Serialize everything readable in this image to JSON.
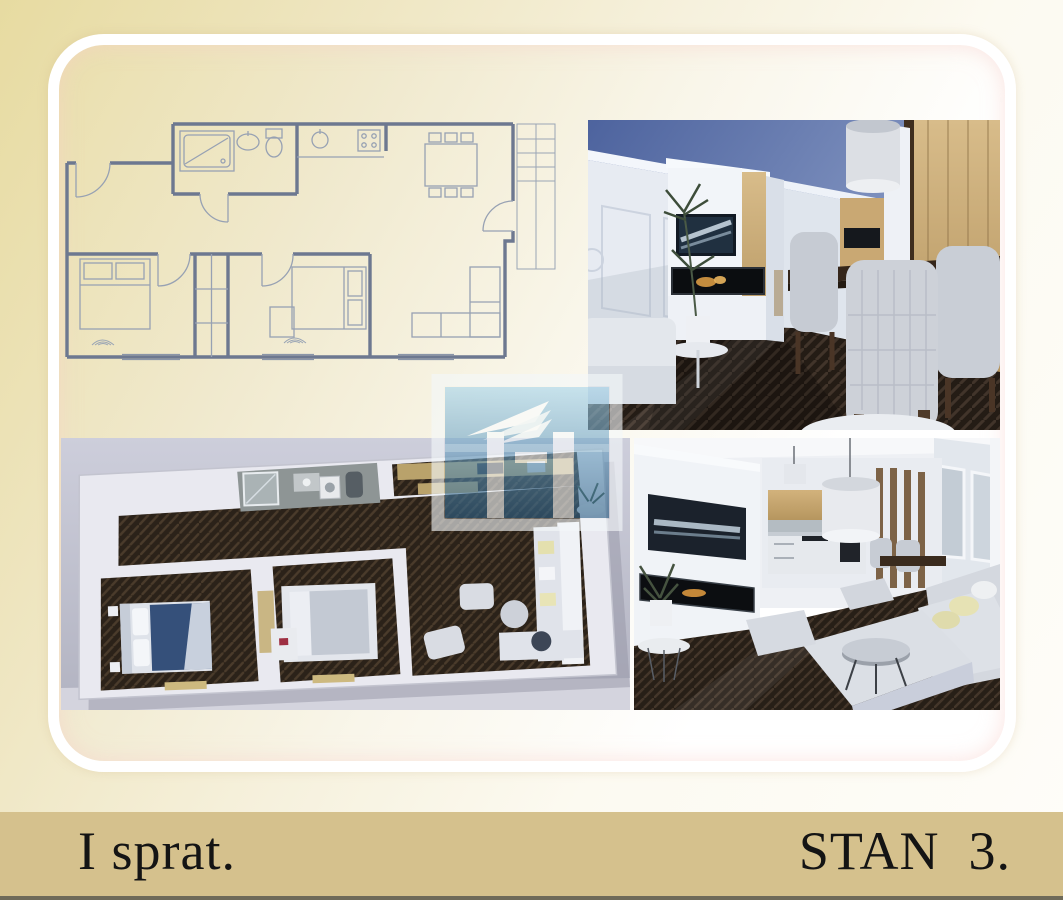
{
  "footer": {
    "floor_label": "I sprat.",
    "unit_label": "STAN  3."
  },
  "images": {
    "floor_plan": "2D floor plan drawing",
    "top_right_render": "3D render of living and dining room",
    "bottom_left_render": "3D top-down apartment render",
    "bottom_right_render": "3D render of living room and kitchen",
    "watermark": "architect logo watermark"
  },
  "colors": {
    "footer_bar": "#d5c18d",
    "footer_text": "#141414",
    "background_tan": "#e7dba1",
    "card_border": "#ffffff",
    "watermark_blue": "#5e93b7",
    "sky_blue": "#5f76ab",
    "wood_tan": "#c9a96e",
    "floor_brown": "#2a221b",
    "plan_line": "#6d7890"
  }
}
